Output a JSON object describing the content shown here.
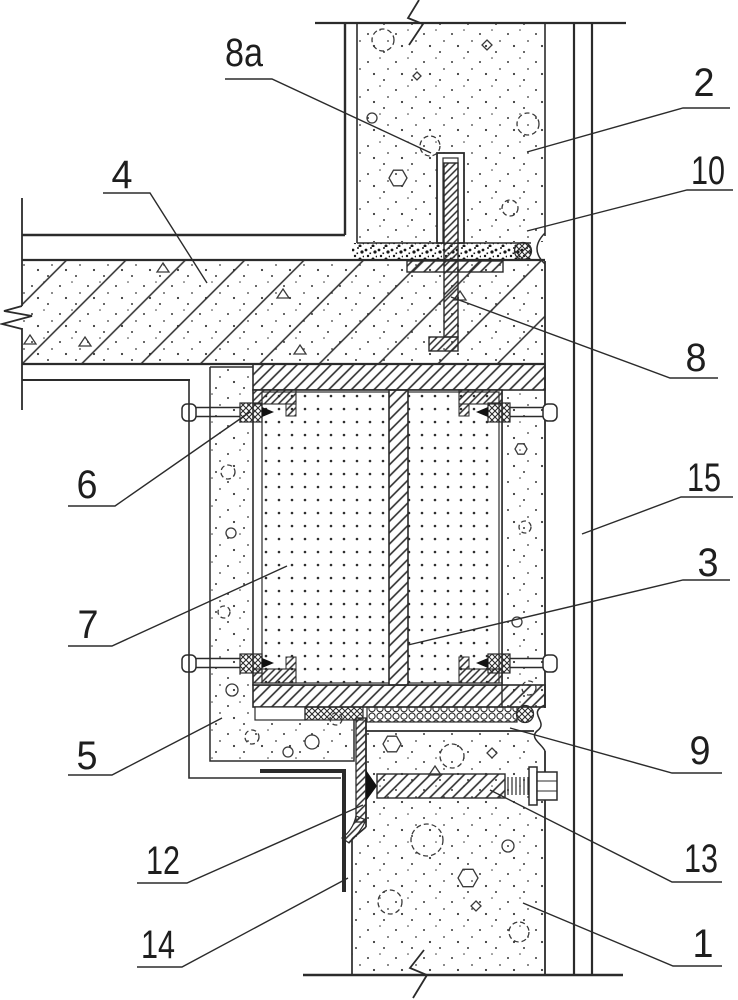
{
  "diagram": {
    "type": "technical-drawing-cross-section",
    "description": "construction joint detail with numbered callouts",
    "colors": {
      "line": "#2b2b2b",
      "background": "#ffffff",
      "fill_dark": "#111111"
    },
    "callouts": [
      {
        "label": "8a"
      },
      {
        "label": "2"
      },
      {
        "label": "10"
      },
      {
        "label": "4"
      },
      {
        "label": "8"
      },
      {
        "label": "6"
      },
      {
        "label": "15"
      },
      {
        "label": "3"
      },
      {
        "label": "7"
      },
      {
        "label": "5"
      },
      {
        "label": "9"
      },
      {
        "label": "12"
      },
      {
        "label": "13"
      },
      {
        "label": "14"
      },
      {
        "label": "1"
      }
    ]
  }
}
